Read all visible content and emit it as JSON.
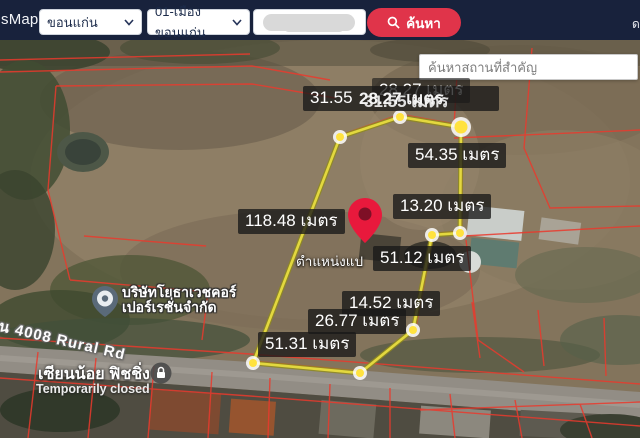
{
  "topbar": {
    "brand": "sMaps",
    "province": "ขอนแก่น",
    "district": "01-เมืองขอนแก่น",
    "search_label": "ค้นหา",
    "edge_glyph": "ด"
  },
  "map_search": {
    "placeholder": "ค้นหาสถานที่สำคัญ"
  },
  "measurements": {
    "top_overlap_back": "31.55",
    "top_overlap_mid": "28.27 เมตร",
    "top_overlap_front1": "28.27 เมตร",
    "top_overlap_front2": "31.55 เมตร",
    "right_top": "54.35 เมตร",
    "right_mid": "13.20 เมตร",
    "left_long": "118.48 เมตร",
    "center": "51.12 เมตร",
    "lower_a": "14.52 เมตร",
    "lower_b": "26.77 เมตร",
    "bottom": "51.31 เมตร",
    "unit": "เมตร"
  },
  "pin": {
    "caption": "ตำแหน่งแป"
  },
  "places": {
    "company_line1": "บริษัทโยธาเวชคอร์",
    "company_line2": "เปอร์เรชั่นจำกัด",
    "road": "น 4008 Rural Rd",
    "closed_name": "เซียนน้อย ฟิชชิ่ง",
    "closed_status": "Temporarily closed"
  },
  "colors": {
    "topbar_bg": "#18223c",
    "search_button": "#e0344a",
    "parcel_polygon": "#e3d83f",
    "cadastral_lines": "#ea3a2d",
    "pin_red": "#e8193c",
    "label_bg": "rgba(24,24,24,0.78)"
  }
}
